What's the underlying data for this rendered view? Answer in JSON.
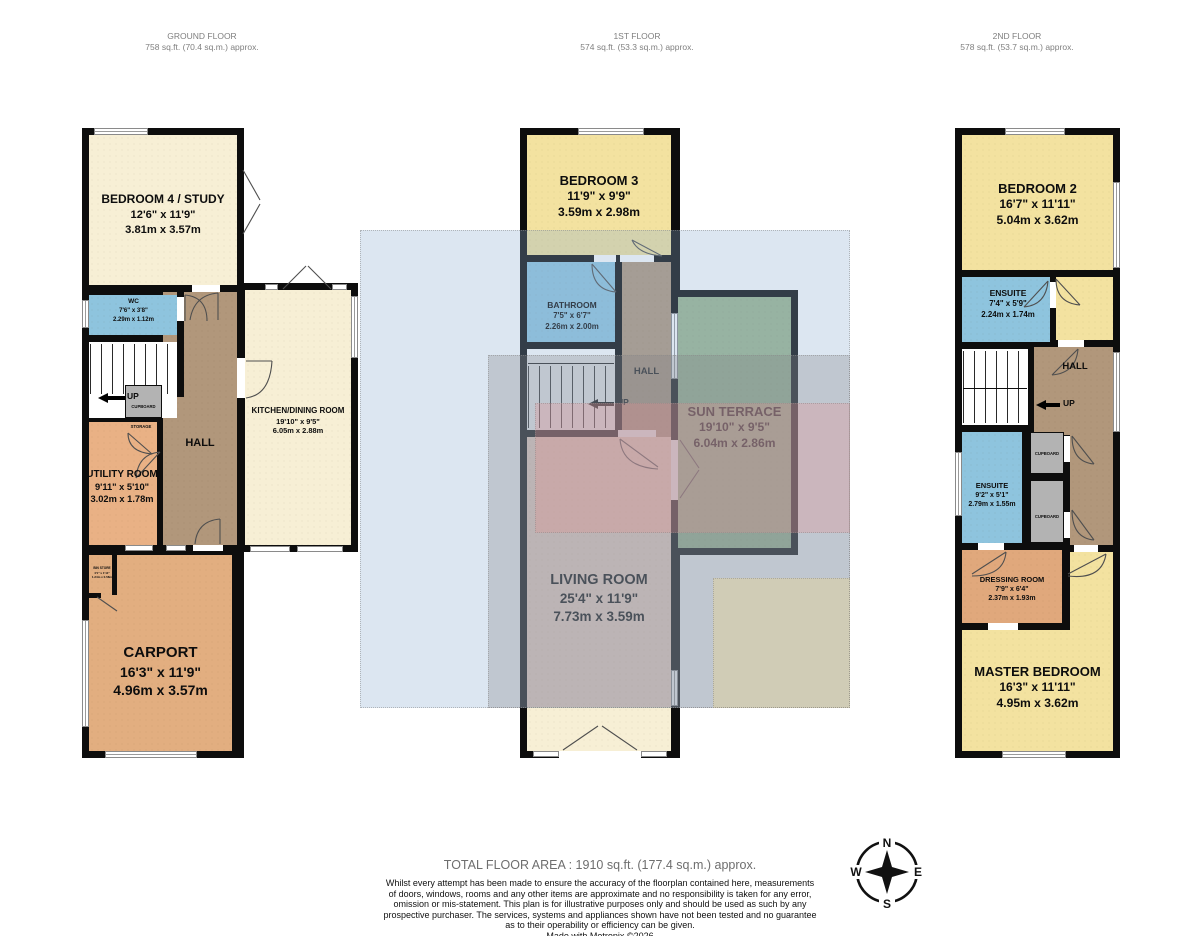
{
  "floors": [
    {
      "name": "GROUND FLOOR",
      "area": "758 sq.ft. (70.4 sq.m.) approx.",
      "rooms": {
        "bedroom4": {
          "name": "BEDROOM 4 / STUDY",
          "imperial": "12'6\"  x 11'9\"",
          "metric": "3.81m  x 3.57m"
        },
        "wc": {
          "name": "WC",
          "imperial": "7'6\"  x 3'8\"",
          "metric": "2.29m  x 1.12m"
        },
        "kitchen": {
          "name": "KITCHEN/DINING ROOM",
          "imperial": "19'10\"  x 9'5\"",
          "metric": "6.05m  x 2.88m"
        },
        "utility": {
          "name": "UTILITY ROOM",
          "imperial": "9'11\"  x 5'10\"",
          "metric": "3.02m  x 1.78m"
        },
        "carport": {
          "name": "CARPORT",
          "imperial": "16'3\"  x 11'9\"",
          "metric": "4.96m  x 3.57m"
        },
        "bin": {
          "name": "BIN STORE",
          "imperial": "4'1\" x 1'11\"",
          "metric": "1.24m x 0.58m"
        },
        "hall": "HALL",
        "up": "UP",
        "cupboard": "CUPBOARD",
        "storage": "STORAGE"
      }
    },
    {
      "name": "1ST FLOOR",
      "area": "574 sq.ft. (53.3 sq.m.) approx.",
      "rooms": {
        "bedroom3": {
          "name": "BEDROOM 3",
          "imperial": "11'9\"  x 9'9\"",
          "metric": "3.59m  x 2.98m"
        },
        "bathroom": {
          "name": "BATHROOM",
          "imperial": "7'5\"  x 6'7\"",
          "metric": "2.26m  x 2.00m"
        },
        "terrace": {
          "name": "SUN TERRACE",
          "imperial": "19'10\"  x 9'5\"",
          "metric": "6.04m  x 2.86m"
        },
        "living": {
          "name": "LIVING ROOM",
          "imperial": "25'4\"  x 11'9\"",
          "metric": "7.73m  x 3.59m"
        },
        "hall": "HALL",
        "up": "UP"
      }
    },
    {
      "name": "2ND FLOOR",
      "area": "578 sq.ft. (53.7 sq.m.) approx.",
      "rooms": {
        "bedroom2": {
          "name": "BEDROOM 2",
          "imperial": "16'7\"  x 11'11\"",
          "metric": "5.04m  x 3.62m"
        },
        "ensuite1": {
          "name": "ENSUITE",
          "imperial": "7'4\"  x 5'9\"",
          "metric": "2.24m  x 1.74m"
        },
        "ensuite2": {
          "name": "ENSUITE",
          "imperial": "9'2\"  x 5'1\"",
          "metric": "2.79m  x 1.55m"
        },
        "dressing": {
          "name": "DRESSING ROOM",
          "imperial": "7'9\"  x 6'4\"",
          "metric": "2.37m  x 1.93m"
        },
        "master": {
          "name": "MASTER BEDROOM",
          "imperial": "16'3\"  x 11'11\"",
          "metric": "4.95m  x 3.62m"
        },
        "hall": "HALL",
        "up": "UP",
        "cupboard": "CUPBOARD"
      }
    }
  ],
  "compass": {
    "n": "N",
    "e": "E",
    "s": "S",
    "w": "W"
  },
  "footer": {
    "total": "TOTAL FLOOR AREA : 1910 sq.ft. (177.4 sq.m.) approx.",
    "disclaimer": [
      "Whilst every attempt has been made to ensure the accuracy of the floorplan contained here, measurements",
      "of doors, windows, rooms and any other items are approximate and no responsibility is taken for any error,",
      "omission or mis-statement. This plan is for illustrative purposes only and should be used as such by any",
      "prospective purchaser. The services, systems and appliances shown have not been tested and no guarantee",
      "as to their operability or efficiency can be given."
    ],
    "credit": "Made with Metropix ©2026"
  },
  "colors": {
    "wall": "#0d0d0d",
    "cream": "#f7efd5",
    "yellow": "#f3e2a0",
    "blue": "#8ec4de",
    "tan": "#b1977b",
    "orange": "#e9b185",
    "carport": "#e2ae80",
    "dressing": "#e0a87c",
    "green": "#9cb68f",
    "pink": "#f7d8c7",
    "gray": "#b3b3b3",
    "overlay_blue": "#dce6f1",
    "overlay_gray": "#d9dadb",
    "overlay_pink": "#f8dcdc",
    "overlay_cream": "#faf3db"
  }
}
